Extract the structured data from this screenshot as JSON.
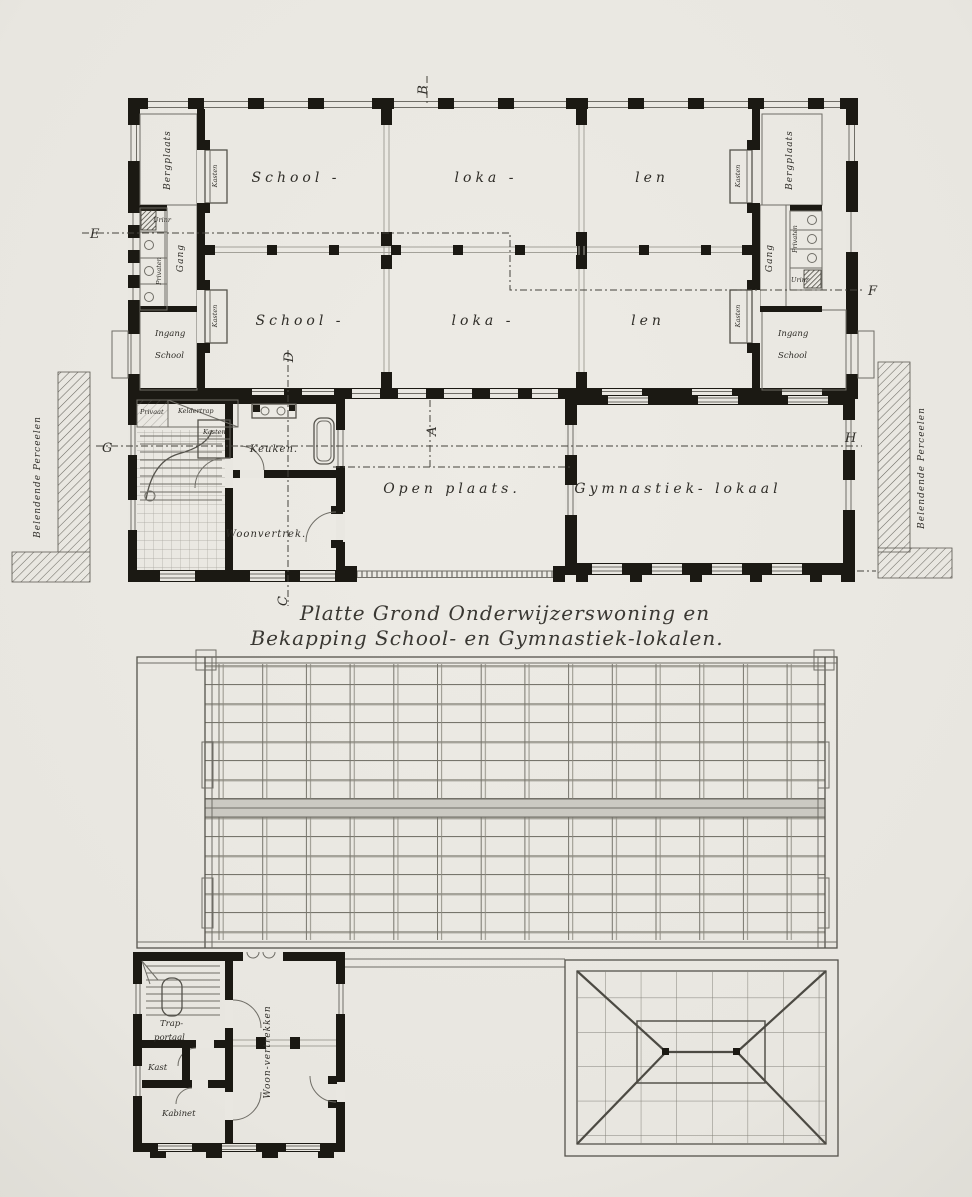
{
  "palette": {
    "paper": "#e9e7e1",
    "ink": "#1b1913",
    "line": "#6f6d66"
  },
  "title": {
    "line1": "Platte Grond Onderwijzerswoning en",
    "line2": "Bekapping School- en Gymnastiek-lokalen."
  },
  "plan": {
    "classrooms": {
      "top_left": "School -",
      "top_mid": "loka -",
      "top_right": "len",
      "bottom_left": "School -",
      "bottom_mid": "loka -",
      "bottom_right": "len"
    },
    "left_wing": {
      "bergplaats": "Bergplaats",
      "urinoir": "Urinr",
      "privaten": "Privaten",
      "gang": "Gang",
      "kasten_top": "Kasten",
      "kasten_bottom": "Kasten",
      "ingang_line1": "Ingang",
      "ingang_line2": "School"
    },
    "right_wing": {
      "bergplaats": "Bergplaats",
      "urinoir": "Urinr",
      "privaten": "Privaten",
      "gang": "Gang",
      "kasten_top": "Kasten",
      "kasten_bottom": "Kasten",
      "ingang_line1": "Ingang",
      "ingang_line2": "School"
    },
    "dwelling": {
      "privaat": "Privaat",
      "keldertrap": "Keldertrap",
      "kasten": "Kasten",
      "keuken": "Keuken.",
      "woonvertrek": "Woonvertrek."
    },
    "courtyard": "Open plaats.",
    "gymnasium": "Gymnastiek- lokaal",
    "adjacent_left": "Belendende Perceelen",
    "adjacent_right": "Belendende Perceelen",
    "markers": {
      "a": "A",
      "b": "B",
      "c": "C",
      "d": "D",
      "e": "E",
      "f": "F",
      "g": "G",
      "h": "H"
    }
  },
  "attic": {
    "trapportaal_line1": "Trap-",
    "trapportaal_line2": "portaal",
    "kast": "Kast",
    "kabinet": "Kabinet",
    "woonvertrekken": "Woon-vertrekken"
  }
}
